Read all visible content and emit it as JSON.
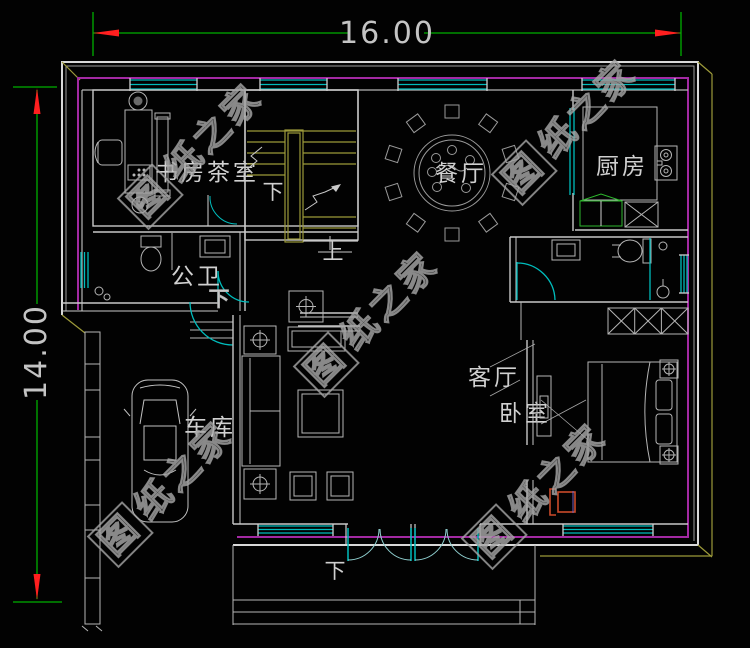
{
  "dimensions": {
    "width": "16.00",
    "height": "14.00"
  },
  "rooms": {
    "study": "书房茶室",
    "guest_bath": "公卫",
    "dining": "餐厅",
    "kitchen": "厨房",
    "garage": "车库",
    "living": "客厅",
    "bedroom": "卧室"
  },
  "stair_labels": {
    "up": "上",
    "down": "下"
  },
  "notes": {
    "hall_down": "下",
    "entry_down": "下"
  },
  "watermark": {
    "text": "图纸之家",
    "logo_char": "图",
    "rest": "纸之家"
  },
  "colors": {
    "background": "#000000",
    "wall_outline": "#d2d2d2",
    "inner_wall": "#a329a3",
    "window": "#00bcbc",
    "stairs": "#9d9a3a",
    "dimension_line": "#00ae00",
    "dimension_arrow": "#ff1f1f",
    "label_text": "#cfcfcf",
    "accent_red": "#cb4b2b"
  }
}
